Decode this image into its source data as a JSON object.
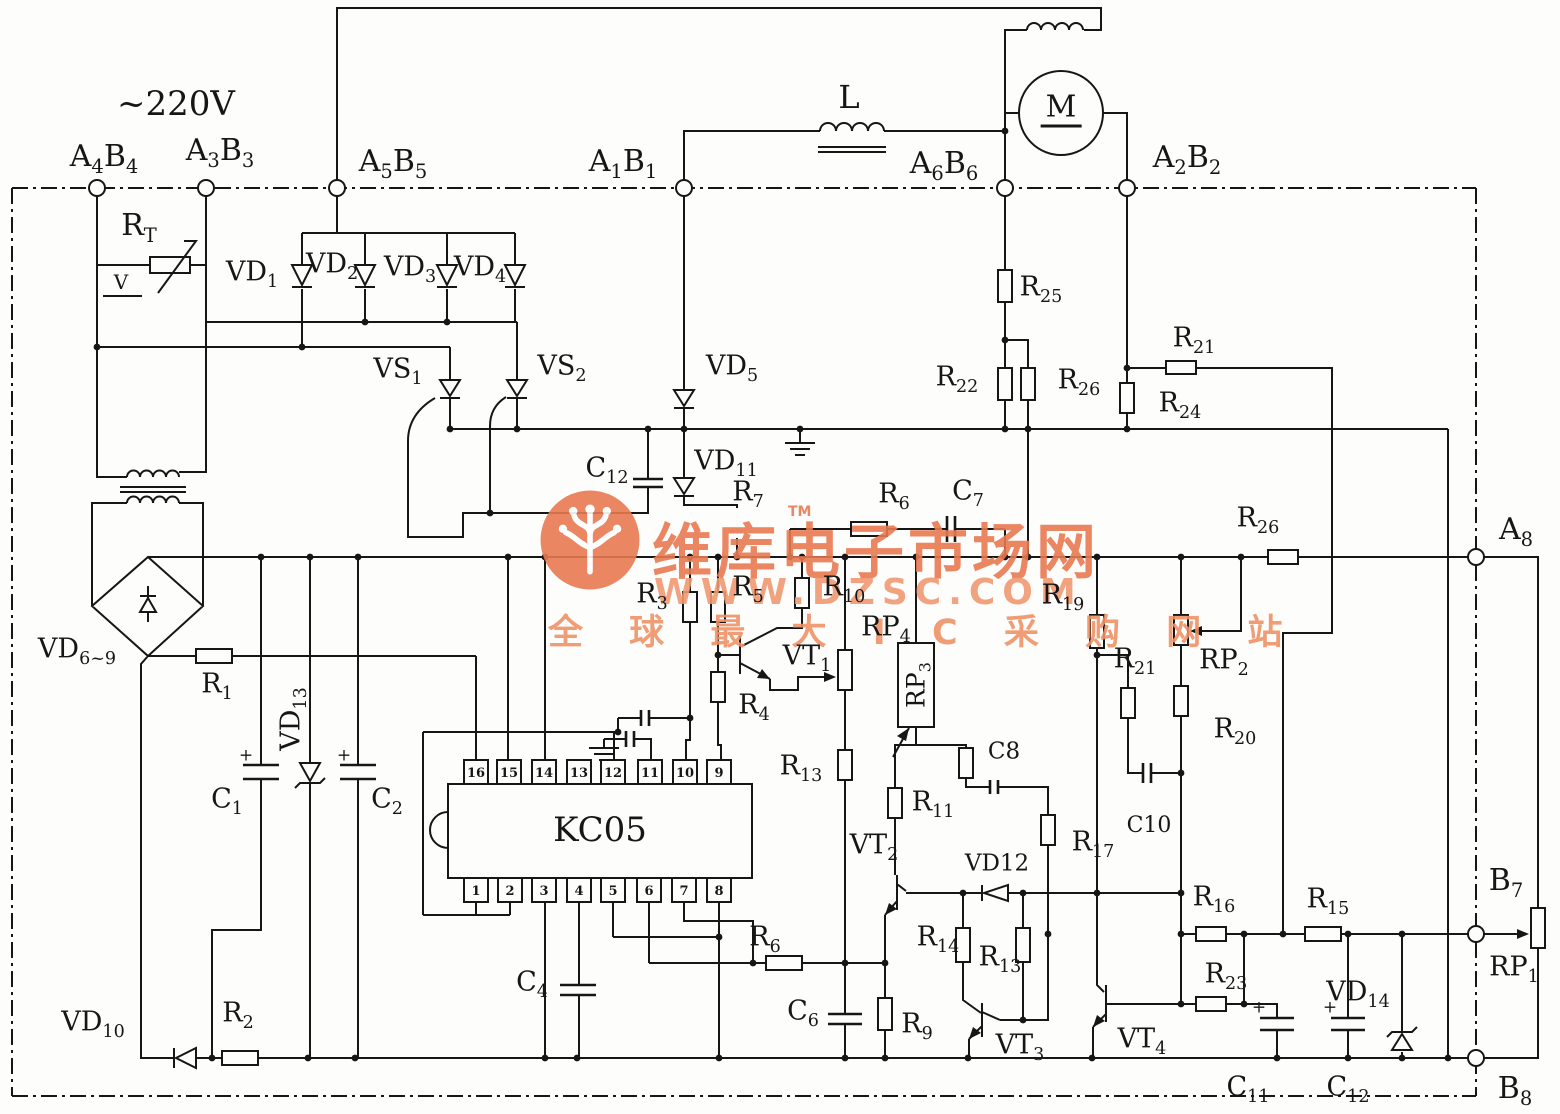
{
  "diagram": {
    "kind": "electronic-schematic",
    "ic": {
      "name": "KC05",
      "pins_top": [
        "16",
        "15",
        "14",
        "13",
        "12",
        "11",
        "10",
        "9"
      ],
      "pins_bottom": [
        "1",
        "2",
        "3",
        "4",
        "5",
        "6",
        "7",
        "8"
      ]
    },
    "watermark": {
      "line1": "维库电子市场网",
      "tm": "TM",
      "line2": "WWW.DZSC.COM",
      "line3": "全 球 最 大 I C 采 购 网 站",
      "color": "#e87a52"
    },
    "labels": [
      {
        "id": "supply-voltage",
        "text": "~220V",
        "x": 176,
        "y": 104,
        "size": 34
      },
      {
        "id": "terminal-a4b4",
        "text": "A_{4}B_{4}",
        "x": 104,
        "y": 157,
        "size": 30
      },
      {
        "id": "terminal-a3b3",
        "text": "A_{3}B_{3}",
        "x": 220,
        "y": 151,
        "size": 30
      },
      {
        "id": "terminal-a5b5",
        "text": "A_{5}B_{5}",
        "x": 393,
        "y": 162,
        "size": 30
      },
      {
        "id": "terminal-a1b1",
        "text": "A_{1}B_{1}",
        "x": 623,
        "y": 162,
        "size": 30
      },
      {
        "id": "terminal-a6b6",
        "text": "A_{6}B_{6}",
        "x": 944,
        "y": 164,
        "size": 30
      },
      {
        "id": "terminal-a2b2",
        "text": "A_{2}B_{2}",
        "x": 1187,
        "y": 158,
        "size": 30
      },
      {
        "id": "terminal-a8",
        "text": "A_{8}",
        "x": 1516,
        "y": 530,
        "size": 30
      },
      {
        "id": "terminal-b7",
        "text": "B_{7}",
        "x": 1506,
        "y": 881,
        "size": 30
      },
      {
        "id": "terminal-b8",
        "text": "B_{8}",
        "x": 1515,
        "y": 1089,
        "size": 30
      },
      {
        "id": "inductor-l",
        "text": "L",
        "x": 849,
        "y": 97,
        "size": 32
      },
      {
        "id": "thermistor-rt",
        "text": "R_{T}",
        "x": 139,
        "y": 226,
        "size": 30
      },
      {
        "id": "varistor-v",
        "text": "V",
        "x": 121,
        "y": 282,
        "size": 20
      },
      {
        "id": "diode-vd1",
        "text": "VD_{1}",
        "x": 252,
        "y": 272,
        "size": 27
      },
      {
        "id": "diode-vd2",
        "text": "VD_{2}",
        "x": 332,
        "y": 264,
        "size": 27
      },
      {
        "id": "diode-vd3",
        "text": "VD_{3}",
        "x": 410,
        "y": 267,
        "size": 27
      },
      {
        "id": "diode-vd4",
        "text": "VD_{4}",
        "x": 480,
        "y": 267,
        "size": 27
      },
      {
        "id": "thyristor-vs1",
        "text": "VS_{1}",
        "x": 398,
        "y": 369,
        "size": 27
      },
      {
        "id": "thyristor-vs2",
        "text": "VS_{2}",
        "x": 562,
        "y": 366,
        "size": 27
      },
      {
        "id": "diode-vd5",
        "text": "VD_{5}",
        "x": 732,
        "y": 366,
        "size": 27
      },
      {
        "id": "cap-c12-top",
        "text": "C_{12}",
        "x": 607,
        "y": 468,
        "size": 27
      },
      {
        "id": "diode-vd11",
        "text": "VD_{11}",
        "x": 726,
        "y": 461,
        "size": 27
      },
      {
        "id": "res-r7",
        "text": "R_{7}",
        "x": 748,
        "y": 492,
        "size": 27
      },
      {
        "id": "res-r6-top",
        "text": "R_{6}",
        "x": 894,
        "y": 494,
        "size": 27
      },
      {
        "id": "cap-c7",
        "text": "C_{7}",
        "x": 968,
        "y": 491,
        "size": 27
      },
      {
        "id": "res-r25",
        "text": "R_{25}",
        "x": 1041,
        "y": 287,
        "size": 27
      },
      {
        "id": "res-r22",
        "text": "R_{22}",
        "x": 957,
        "y": 377,
        "size": 27
      },
      {
        "id": "res-r26-mid",
        "text": "R_{26}",
        "x": 1079,
        "y": 380,
        "size": 27
      },
      {
        "id": "res-r21-top",
        "text": "R_{21}",
        "x": 1194,
        "y": 338,
        "size": 27
      },
      {
        "id": "res-r24",
        "text": "R_{24}",
        "x": 1180,
        "y": 403,
        "size": 27
      },
      {
        "id": "res-r26-right",
        "text": "R_{26}",
        "x": 1258,
        "y": 518,
        "size": 27
      },
      {
        "id": "res-r3",
        "text": "R_{3}",
        "x": 652,
        "y": 594,
        "size": 27
      },
      {
        "id": "res-r5",
        "text": "R_{5}",
        "x": 748,
        "y": 587,
        "size": 27
      },
      {
        "id": "res-r10",
        "text": "R_{10}",
        "x": 844,
        "y": 587,
        "size": 27
      },
      {
        "id": "pot-rp4",
        "text": "RP_{4}",
        "x": 886,
        "y": 627,
        "size": 27
      },
      {
        "id": "pot-rp3",
        "text": "RP_{3}",
        "x": 916,
        "y": 685,
        "size": 25,
        "rot": true
      },
      {
        "id": "res-r19",
        "text": "R_{19}",
        "x": 1063,
        "y": 595,
        "size": 27
      },
      {
        "id": "res-r21-mid",
        "text": "R_{21}",
        "x": 1135,
        "y": 659,
        "size": 27
      },
      {
        "id": "pot-rp2",
        "text": "RP_{2}",
        "x": 1224,
        "y": 660,
        "size": 27
      },
      {
        "id": "res-r20",
        "text": "R_{20}",
        "x": 1235,
        "y": 729,
        "size": 27
      },
      {
        "id": "res-r4",
        "text": "R_{4}",
        "x": 754,
        "y": 705,
        "size": 27
      },
      {
        "id": "res-r13-a",
        "text": "R_{13}",
        "x": 801,
        "y": 766,
        "size": 27
      },
      {
        "id": "res-r11",
        "text": "R_{11}",
        "x": 933,
        "y": 802,
        "size": 27
      },
      {
        "id": "cap-c8",
        "text": "C8",
        "x": 1004,
        "y": 752,
        "size": 23
      },
      {
        "id": "cap-c10",
        "text": "C10",
        "x": 1149,
        "y": 826,
        "size": 22
      },
      {
        "id": "res-r17",
        "text": "R_{17}",
        "x": 1093,
        "y": 842,
        "size": 27
      },
      {
        "id": "bridge-vd6-9",
        "text": "VD_{6~9}",
        "x": 77,
        "y": 649,
        "size": 27
      },
      {
        "id": "res-r1",
        "text": "R_{1}",
        "x": 217,
        "y": 684,
        "size": 27
      },
      {
        "id": "diode-vd13",
        "text": "VD_{13}",
        "x": 291,
        "y": 719,
        "size": 27,
        "rot": true
      },
      {
        "id": "cap-c1",
        "text": "C_{1}",
        "x": 227,
        "y": 799,
        "size": 27
      },
      {
        "id": "cap-c2",
        "text": "C_{2}",
        "x": 387,
        "y": 799,
        "size": 27
      },
      {
        "id": "ic-kc05",
        "text": "KC05",
        "x": 600,
        "y": 830,
        "size": 34
      },
      {
        "id": "transistor-vt1",
        "text": "VT_{1}",
        "x": 807,
        "y": 656,
        "size": 27
      },
      {
        "id": "transistor-vt2",
        "text": "VT_{2}",
        "x": 874,
        "y": 845,
        "size": 27
      },
      {
        "id": "diode-vd12",
        "text": "VD12",
        "x": 997,
        "y": 864,
        "size": 23
      },
      {
        "id": "res-r14",
        "text": "R_{14}",
        "x": 938,
        "y": 937,
        "size": 27
      },
      {
        "id": "res-r13-b",
        "text": "R_{13}",
        "x": 1000,
        "y": 957,
        "size": 27
      },
      {
        "id": "res-r16",
        "text": "R_{16}",
        "x": 1214,
        "y": 897,
        "size": 27
      },
      {
        "id": "res-r15",
        "text": "R_{15}",
        "x": 1328,
        "y": 899,
        "size": 27
      },
      {
        "id": "pot-rp1",
        "text": "RP_{1}",
        "x": 1514,
        "y": 967,
        "size": 27
      },
      {
        "id": "res-r23",
        "text": "R_{23}",
        "x": 1226,
        "y": 974,
        "size": 27
      },
      {
        "id": "diode-vd14",
        "text": "VD_{14}",
        "x": 1358,
        "y": 992,
        "size": 27
      },
      {
        "id": "cap-c4",
        "text": "C_{4}",
        "x": 532,
        "y": 982,
        "size": 27
      },
      {
        "id": "res-r6-bottom",
        "text": "R_{6}",
        "x": 765,
        "y": 937,
        "size": 27
      },
      {
        "id": "cap-c6",
        "text": "C_{6}",
        "x": 803,
        "y": 1011,
        "size": 27
      },
      {
        "id": "res-r9",
        "text": "R_{9}",
        "x": 917,
        "y": 1024,
        "size": 27
      },
      {
        "id": "transistor-vt3",
        "text": "VT_{3}",
        "x": 1020,
        "y": 1045,
        "size": 27
      },
      {
        "id": "transistor-vt4",
        "text": "VT_{4}",
        "x": 1142,
        "y": 1039,
        "size": 27
      },
      {
        "id": "diode-vd10",
        "text": "VD_{10}",
        "x": 93,
        "y": 1022,
        "size": 27
      },
      {
        "id": "res-r2",
        "text": "R_{2}",
        "x": 238,
        "y": 1013,
        "size": 27
      },
      {
        "id": "cap-c11",
        "text": "C_{11}",
        "x": 1248,
        "y": 1087,
        "size": 27
      },
      {
        "id": "cap-c12-bottom",
        "text": "C_{12}",
        "x": 1348,
        "y": 1087,
        "size": 27
      },
      {
        "id": "motor-m",
        "text": "M",
        "x": 1061,
        "y": 110,
        "size": 30,
        "motor": true
      },
      {
        "id": "plus-c1",
        "text": "+",
        "x": 246,
        "y": 756,
        "size": 17
      },
      {
        "id": "plus-c2",
        "text": "+",
        "x": 344,
        "y": 756,
        "size": 17
      },
      {
        "id": "plus-c11",
        "text": "+",
        "x": 1259,
        "y": 1008,
        "size": 17
      },
      {
        "id": "plus-c12",
        "text": "+",
        "x": 1330,
        "y": 1008,
        "size": 17
      }
    ]
  }
}
